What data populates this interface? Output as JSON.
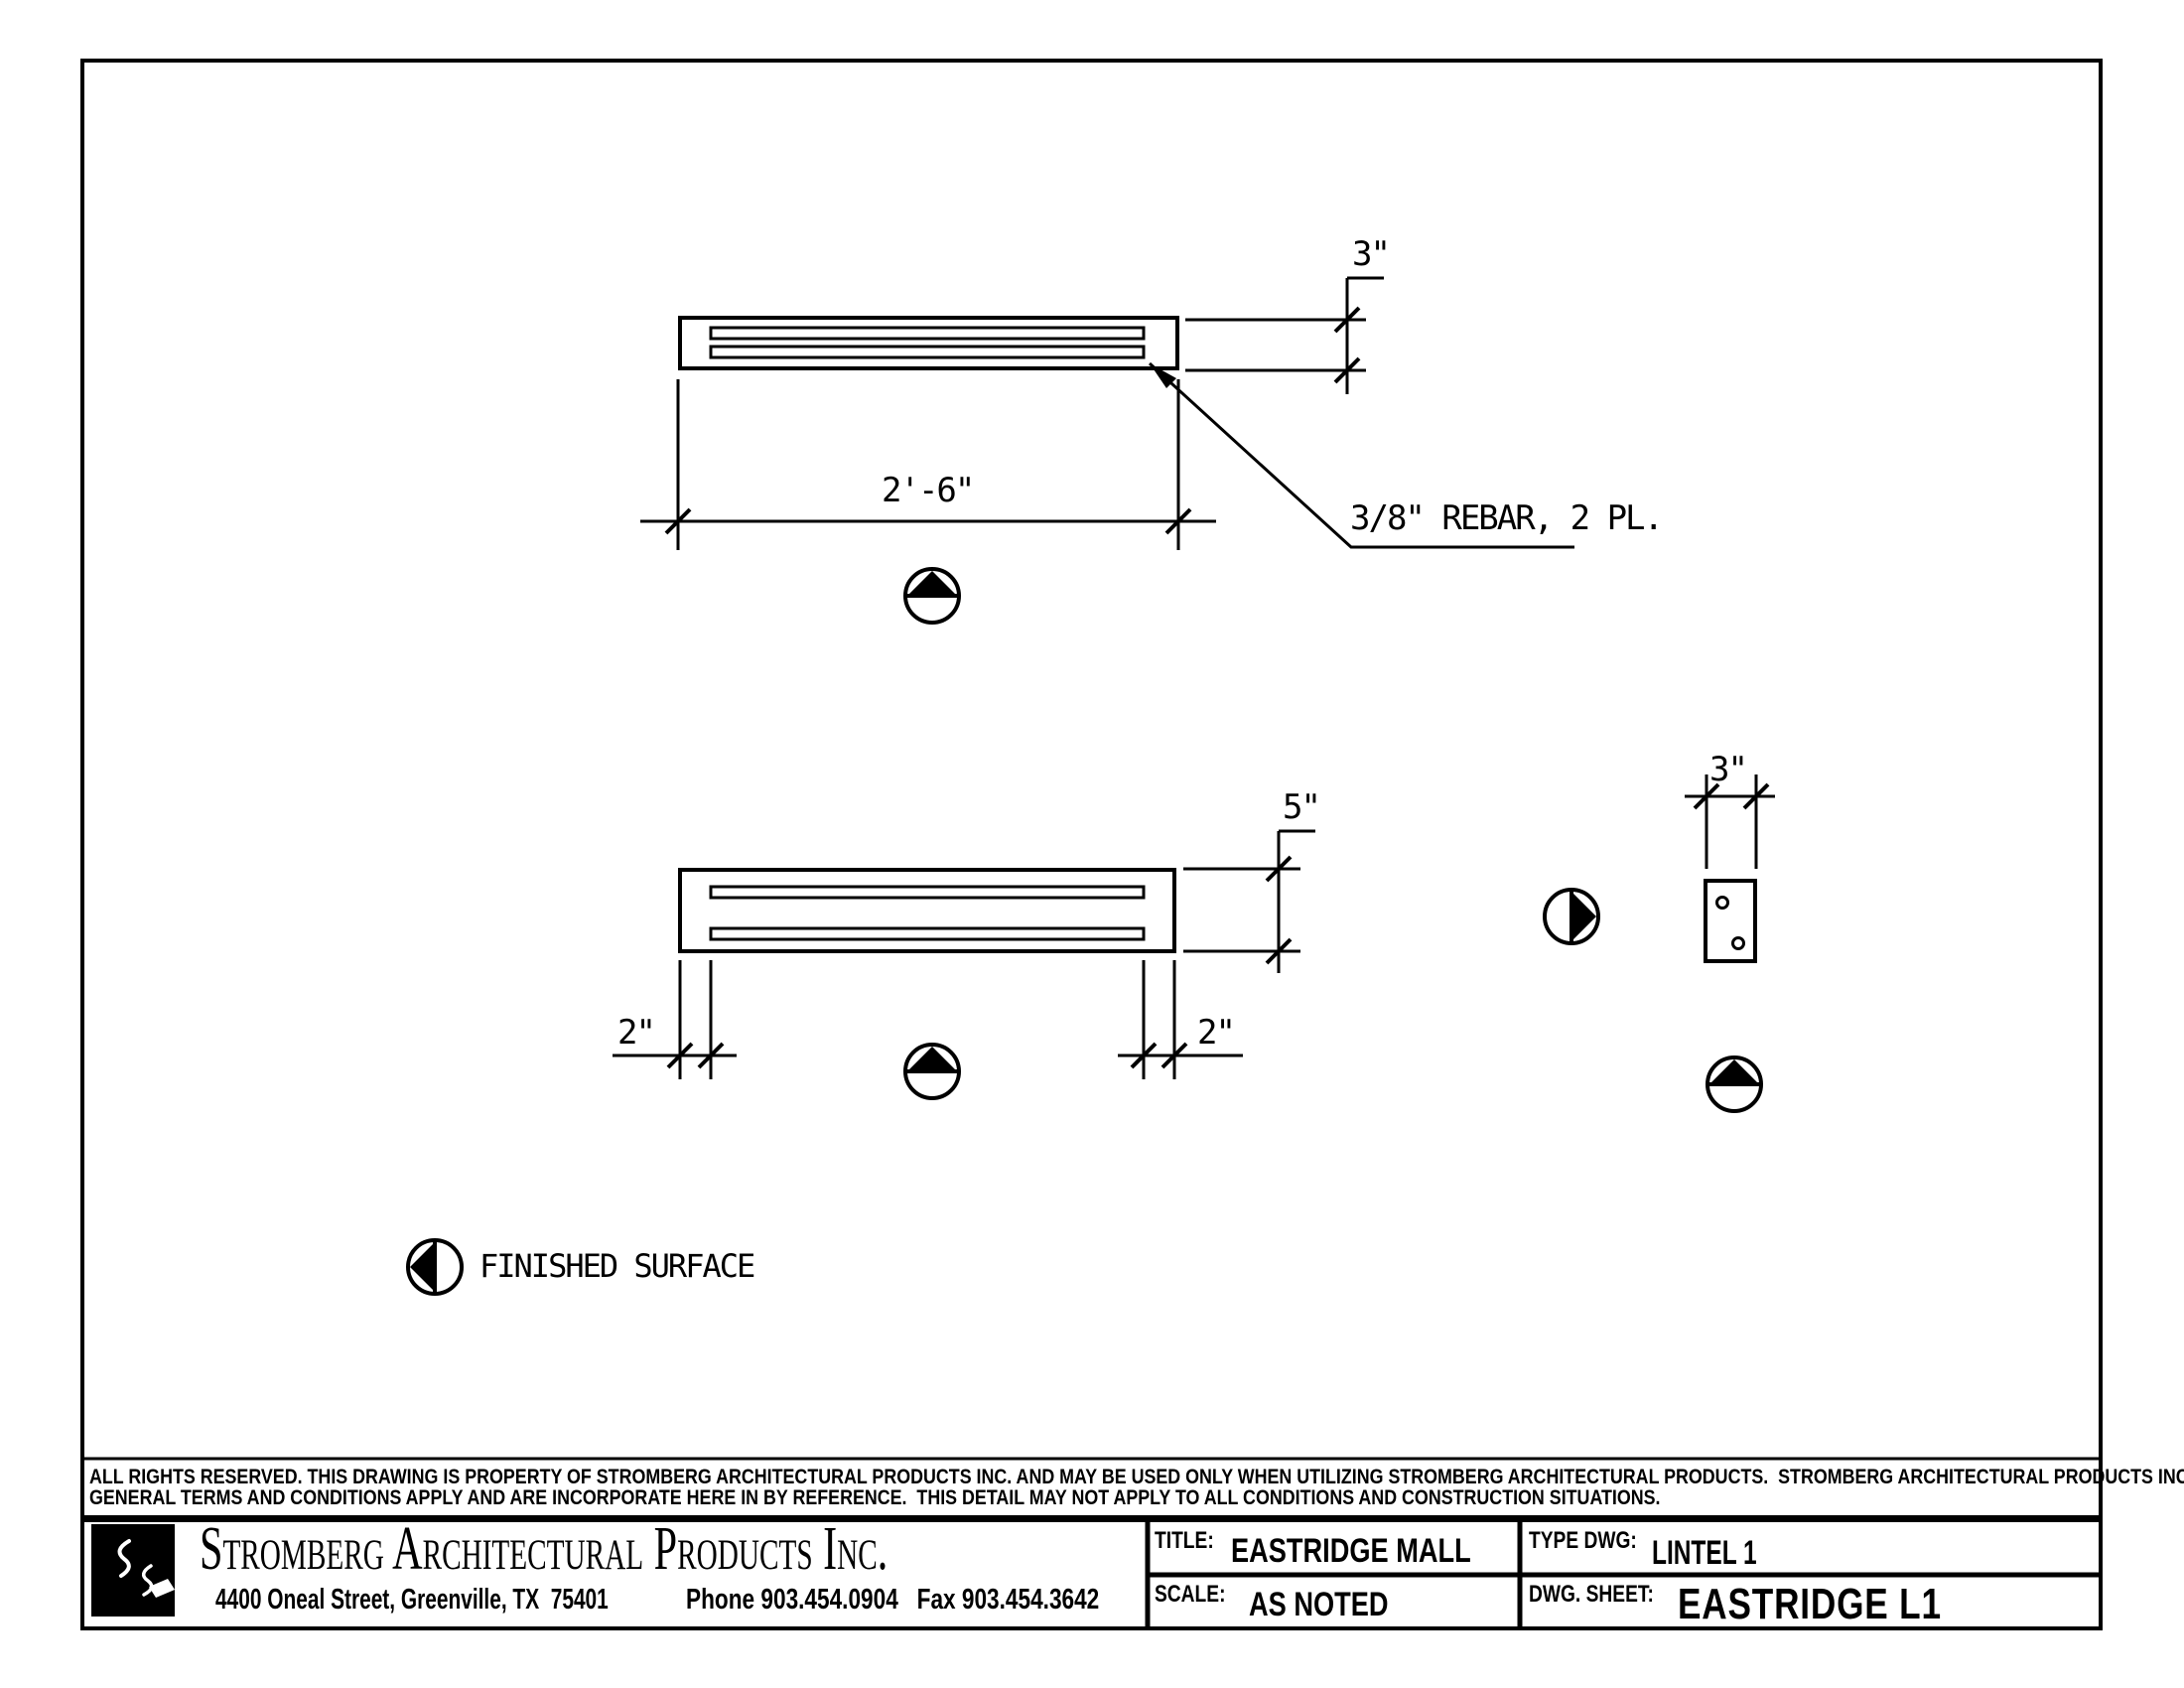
{
  "drawing": {
    "annotations": {
      "top_thickness": "3\"",
      "top_length": "2'-6\"",
      "rebar_note": "3/8\" REBAR, 2 PL.",
      "side_height": "5\"",
      "end_offset_left": "2\"",
      "end_offset_right": "2\"",
      "section_width": "3\"",
      "legend": "FINISHED SURFACE"
    },
    "symbols": [
      "finished-surface-marker-up-top-view",
      "finished-surface-marker-up-side-view",
      "finished-surface-marker-right-section",
      "finished-surface-marker-up-section",
      "finished-surface-marker-left-legend"
    ],
    "colors": {
      "line": "#000000",
      "background": "#ffffff"
    }
  },
  "legal": {
    "line1": "ALL RIGHTS RESERVED. THIS DRAWING IS PROPERTY OF STROMBERG ARCHITECTURAL PRODUCTS INC. AND MAY BE USED ONLY WHEN UTILIZING STROMBERG ARCHITECTURAL PRODUCTS.  STROMBERG ARCHITECTURAL PRODUCTS INC.",
    "line2": "GENERAL TERMS AND CONDITIONS APPLY AND ARE INCORPORATE HERE IN BY REFERENCE.  THIS DETAIL MAY NOT APPLY TO ALL CONDITIONS AND CONSTRUCTION SITUATIONS."
  },
  "title_block": {
    "company": "Stromberg Architectural Products Inc.",
    "address": "4400 Oneal Street, Greenville, TX  75401",
    "phone_fax": "Phone 903.454.0904   Fax 903.454.3642",
    "title_label": "TITLE:",
    "title_value": "EASTRIDGE MALL",
    "type_dwg_label": "TYPE DWG:",
    "type_dwg_value": "LINTEL 1",
    "scale_label": "SCALE:",
    "scale_value": "AS NOTED",
    "sheet_label": "DWG. SHEET:",
    "sheet_value": "EASTRIDGE L1"
  }
}
